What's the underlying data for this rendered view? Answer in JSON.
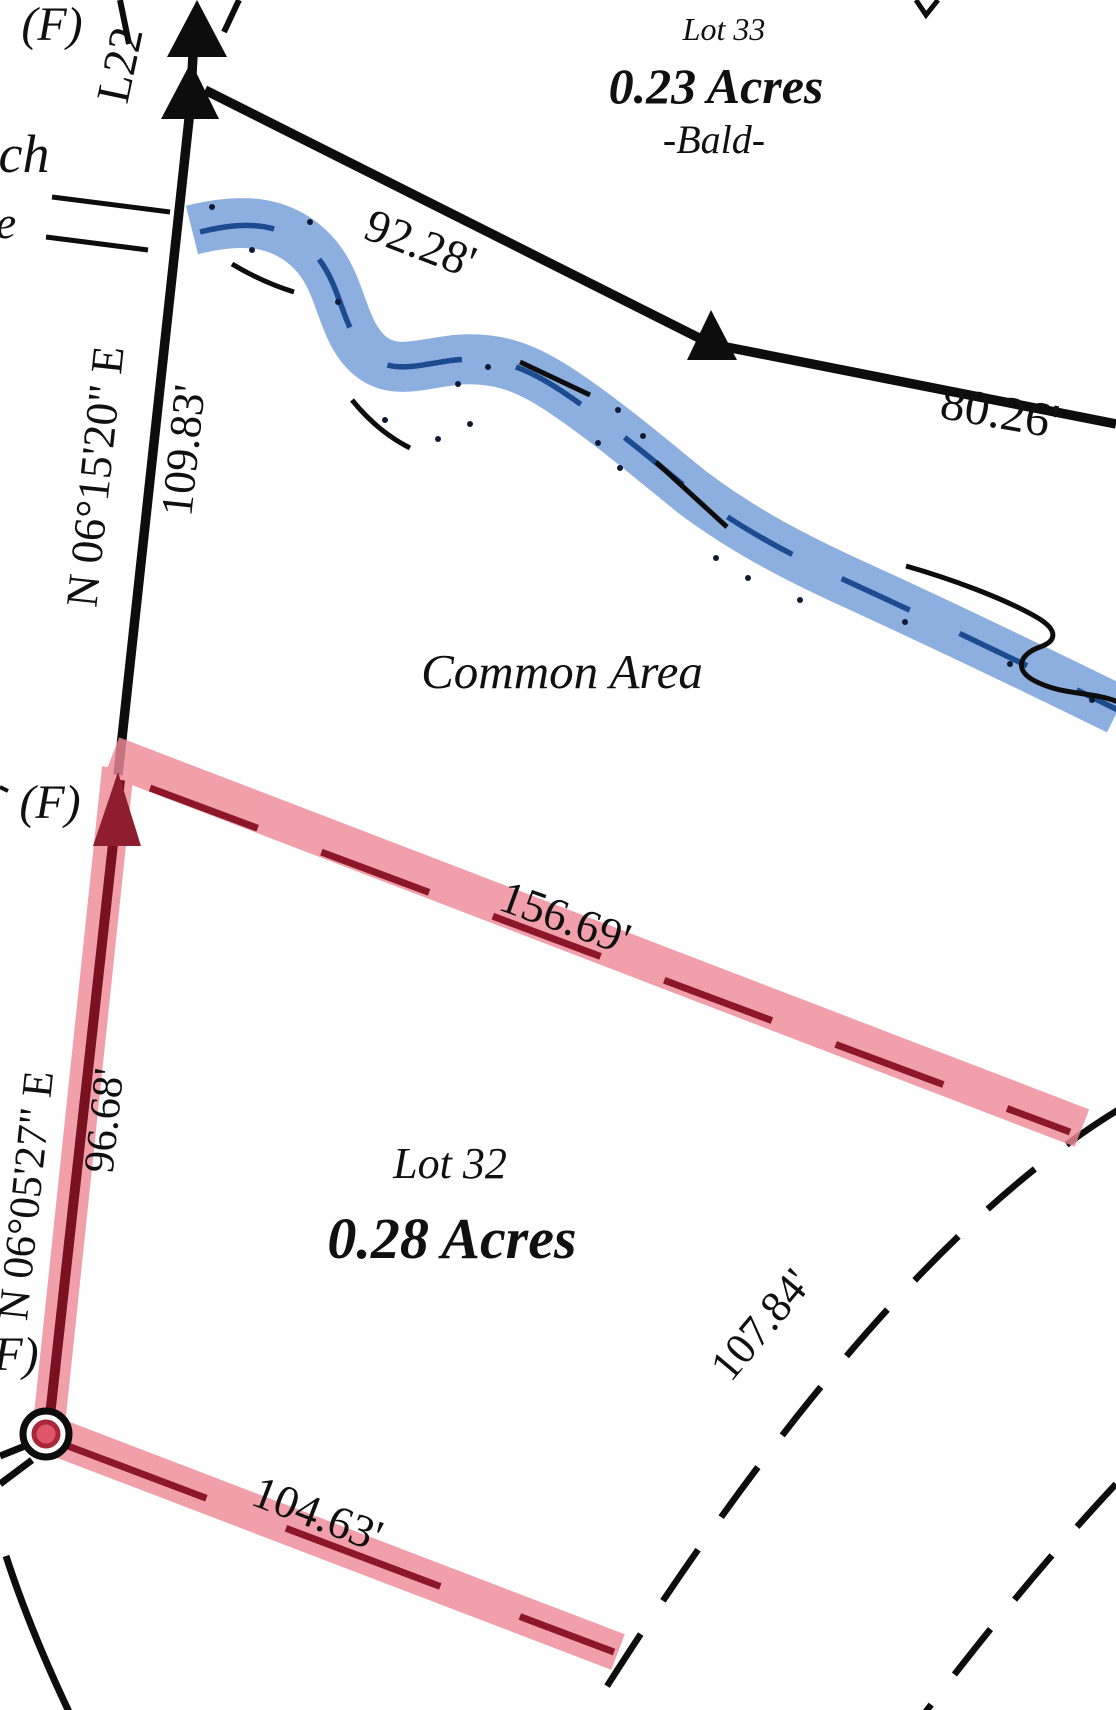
{
  "map": {
    "parcels": {
      "lot33": {
        "name": "Lot 33",
        "area": "0.23 Acres",
        "note": "-Bald-"
      },
      "lot32": {
        "name": "Lot 32",
        "area": "0.28 Acres"
      },
      "common_area_label": "Common Area"
    },
    "dimensions": {
      "seg_9228": "92.28'",
      "seg_8026": "80.26'",
      "bearing_0615": "N 06°15'20\" E",
      "dist_10983": "109.83'",
      "seg_15669": "156.69'",
      "bearing_0605": "N 06°05'27\" E",
      "dist_9668": "96.68'",
      "arc_10784": "107.84'",
      "seg_10463": "104.63'",
      "line_label": "L22"
    },
    "markers": {
      "found_top": "(F)",
      "found_mid": "(F)",
      "found_bottom": "(F)"
    },
    "partial_labels": {
      "ch": "ch",
      "e": "e"
    },
    "colors": {
      "stream_fill": "#8cafdf",
      "stream_centerline": "#1d4b8f",
      "highlight_pink": "#ee8a97",
      "highlight_dark_red": "#8c1728",
      "boundary_black": "#0d0d0d",
      "marker_red": "#e1556a"
    }
  }
}
